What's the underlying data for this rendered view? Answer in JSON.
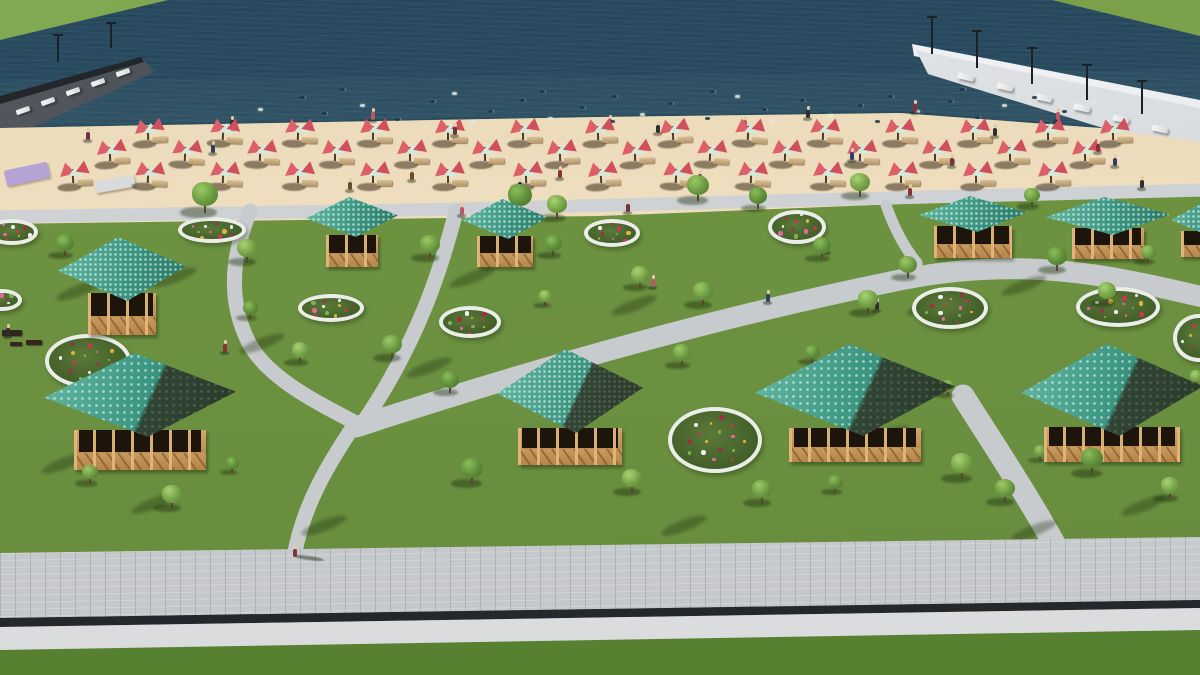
{
  "scene": {
    "type": "architectural-3d-render",
    "subject": "aerial view of lakeside beach park with gazebos, parasols, flower beds and promenade",
    "colors": {
      "water": "#2b5064",
      "sand": "#eddcbc",
      "grass": "#6b9040",
      "grass_lower": "#5e8636",
      "path": "#c8cbcd",
      "promenade": "#cdd0d2",
      "curb": "#eef0f2",
      "gap": "#24272b",
      "roof_teal": "#389480",
      "wood": "#c79a5e",
      "wood_dark": "#1d140b",
      "umbrella_red": "#dd5f68",
      "umbrella_mint": "#d4e9da",
      "flower_rim": "#eaede8",
      "pier_left": "#3a3f46",
      "pier_right": "#dcdfe1",
      "bank_green": "#74a04a",
      "mat_purple": "#b4a3d4",
      "mat_gray": "#d9dadb"
    },
    "paths": {
      "walkway": "M-5,217 L460,209 L1205,190",
      "s_curve": "M250,211 C233,252 226,298 249,343 C268,379 320,404 356,423",
      "branch_b": "M456,211 C443,262 420,340 362,424",
      "main_diagonal": "M356,427 C530,370 720,316 905,279 C1030,255 1120,278 1203,297",
      "spur": "M886,205 C894,228 904,247 917,263",
      "branch_d": "M353,427 C329,463 303,505 294,557",
      "branch_e": "M963,396 C992,442 1032,502 1058,551"
    },
    "gazebos": [
      {
        "cx": 122,
        "roofTop": 237,
        "roofW": 128,
        "roofH": 64,
        "bodyW": 68,
        "bodyH": 42,
        "bodyTop": 293,
        "dark": 0
      },
      {
        "cx": 352,
        "roofTop": 197,
        "roofW": 92,
        "roofH": 40,
        "bodyW": 52,
        "bodyH": 32,
        "bodyTop": 235,
        "dark": 0
      },
      {
        "cx": 505,
        "roofTop": 199,
        "roofW": 86,
        "roofH": 40,
        "bodyW": 56,
        "bodyH": 31,
        "bodyTop": 236,
        "dark": 0
      },
      {
        "cx": 973,
        "roofTop": 196,
        "roofW": 108,
        "roofH": 36,
        "bodyW": 78,
        "bodyH": 32,
        "bodyTop": 226,
        "dark": 0
      },
      {
        "cx": 1108,
        "roofTop": 197,
        "roofW": 125,
        "roofH": 38,
        "bodyW": 72,
        "bodyH": 31,
        "bodyTop": 228,
        "dark": 0
      },
      {
        "cx": 1202,
        "roofTop": 204,
        "roofW": 62,
        "roofH": 30,
        "bodyW": 42,
        "bodyH": 26,
        "bodyTop": 231,
        "dark": 0
      },
      {
        "cx": 140,
        "roofTop": 353,
        "roofW": 192,
        "roofH": 84,
        "bodyW": 132,
        "bodyH": 40,
        "bodyTop": 430,
        "dark": 1
      },
      {
        "cx": 570,
        "roofTop": 349,
        "roofW": 146,
        "roofH": 84,
        "bodyW": 104,
        "bodyH": 37,
        "bodyTop": 428,
        "dark": 1
      },
      {
        "cx": 855,
        "roofTop": 344,
        "roofW": 200,
        "roofH": 92,
        "bodyW": 132,
        "bodyH": 34,
        "bodyTop": 428,
        "dark": 1
      },
      {
        "cx": 1112,
        "roofTop": 344,
        "roofW": 182,
        "roofH": 92,
        "bodyW": 136,
        "bodyH": 35,
        "bodyTop": 427,
        "dark": 1
      }
    ],
    "flowerbeds": [
      [
        12,
        232,
        26,
        13
      ],
      [
        212,
        230,
        34,
        13
      ],
      [
        331,
        308,
        33,
        14
      ],
      [
        470,
        322,
        31,
        16
      ],
      [
        612,
        233,
        28,
        14
      ],
      [
        797,
        227,
        29,
        17
      ],
      [
        950,
        308,
        38,
        21
      ],
      [
        1118,
        307,
        42,
        20
      ],
      [
        1199,
        338,
        26,
        24
      ],
      [
        715,
        440,
        47,
        33
      ],
      [
        88,
        361,
        43,
        27
      ],
      [
        2,
        300,
        20,
        11
      ]
    ],
    "flower_palette": [
      "#cf3550",
      "#e46a9e",
      "#f2f1ee",
      "#e0b43c",
      "#83b152",
      "#a22d3f"
    ],
    "trees": [
      [
        205,
        212,
        26
      ],
      [
        520,
        212,
        24
      ],
      [
        557,
        218,
        20
      ],
      [
        698,
        200,
        22
      ],
      [
        758,
        208,
        18
      ],
      [
        860,
        196,
        20
      ],
      [
        1032,
        206,
        16
      ],
      [
        65,
        255,
        18
      ],
      [
        247,
        262,
        20
      ],
      [
        430,
        258,
        20
      ],
      [
        553,
        255,
        17
      ],
      [
        640,
        287,
        18
      ],
      [
        703,
        305,
        20
      ],
      [
        822,
        258,
        18
      ],
      [
        868,
        313,
        20
      ],
      [
        908,
        277,
        18
      ],
      [
        1057,
        270,
        20
      ],
      [
        1107,
        303,
        18
      ],
      [
        1148,
        262,
        15
      ],
      [
        250,
        318,
        15
      ],
      [
        300,
        362,
        17
      ],
      [
        392,
        358,
        20
      ],
      [
        450,
        392,
        18
      ],
      [
        545,
        305,
        13
      ],
      [
        682,
        365,
        18
      ],
      [
        812,
        362,
        15
      ],
      [
        872,
        405,
        16
      ],
      [
        948,
        395,
        13
      ],
      [
        472,
        483,
        22
      ],
      [
        632,
        492,
        20
      ],
      [
        762,
        503,
        20
      ],
      [
        552,
        455,
        15
      ],
      [
        172,
        508,
        20
      ],
      [
        90,
        483,
        16
      ],
      [
        232,
        472,
        13
      ],
      [
        962,
        478,
        22
      ],
      [
        1005,
        502,
        20
      ],
      [
        1092,
        473,
        22
      ],
      [
        1170,
        498,
        18
      ],
      [
        1040,
        460,
        13
      ],
      [
        835,
        492,
        15
      ],
      [
        1196,
        385,
        13
      ]
    ],
    "umbrella_rows": [
      {
        "y": 132,
        "xs": [
          150,
          225,
          300,
          375,
          450,
          525,
          600,
          675,
          750,
          825,
          900,
          975,
          1050,
          1115
        ]
      },
      {
        "y": 153,
        "xs": [
          112,
          187,
          262,
          337,
          412,
          487,
          562,
          637,
          712,
          787,
          862,
          937,
          1012,
          1087
        ]
      },
      {
        "y": 175,
        "xs": [
          75,
          150,
          225,
          300,
          375,
          450,
          528,
          603,
          678,
          753,
          828,
          903,
          978,
          1053
        ]
      }
    ],
    "people": [
      [
        88,
        140,
        0
      ],
      [
        213,
        153,
        1
      ],
      [
        232,
        128,
        3
      ],
      [
        373,
        120,
        2
      ],
      [
        412,
        180,
        4
      ],
      [
        455,
        135,
        0
      ],
      [
        520,
        190,
        3
      ],
      [
        560,
        178,
        5
      ],
      [
        610,
        127,
        1
      ],
      [
        658,
        133,
        3
      ],
      [
        700,
        182,
        0
      ],
      [
        745,
        128,
        2
      ],
      [
        808,
        118,
        3
      ],
      [
        852,
        160,
        1
      ],
      [
        915,
        112,
        5
      ],
      [
        952,
        166,
        0
      ],
      [
        995,
        136,
        3
      ],
      [
        1058,
        120,
        2
      ],
      [
        1098,
        152,
        5
      ],
      [
        1115,
        166,
        1
      ],
      [
        1142,
        188,
        3
      ],
      [
        350,
        190,
        4
      ],
      [
        462,
        215,
        2
      ],
      [
        628,
        212,
        0
      ],
      [
        910,
        196,
        5
      ],
      [
        225,
        352,
        5
      ],
      [
        8,
        336,
        3
      ],
      [
        768,
        302,
        1
      ],
      [
        877,
        310,
        3
      ],
      [
        827,
        252,
        0
      ],
      [
        653,
        287,
        2
      ],
      [
        295,
        557,
        5
      ]
    ],
    "people_palette": [
      "#6e3340",
      "#343d66",
      "#b65a69",
      "#2e2e31",
      "#6d4a2d",
      "#8a2f3b"
    ],
    "swimmers": [
      [
        258,
        108
      ],
      [
        300,
        96
      ],
      [
        322,
        112
      ],
      [
        360,
        104
      ],
      [
        395,
        118
      ],
      [
        430,
        100
      ],
      [
        452,
        92
      ],
      [
        488,
        110
      ],
      [
        520,
        99
      ],
      [
        548,
        117
      ],
      [
        580,
        106
      ],
      [
        612,
        95
      ],
      [
        640,
        113
      ],
      [
        668,
        102
      ],
      [
        705,
        117
      ],
      [
        735,
        95
      ],
      [
        762,
        108
      ],
      [
        800,
        99
      ],
      [
        828,
        114
      ],
      [
        858,
        104
      ],
      [
        888,
        95
      ],
      [
        915,
        110
      ],
      [
        948,
        100
      ],
      [
        975,
        116
      ],
      [
        1002,
        104
      ],
      [
        1032,
        96
      ],
      [
        1062,
        110
      ],
      [
        1092,
        100
      ],
      [
        340,
        88
      ],
      [
        710,
        90
      ],
      [
        770,
        120
      ],
      [
        875,
        120
      ],
      [
        610,
        120
      ],
      [
        470,
        121
      ],
      [
        540,
        90
      ],
      [
        960,
        88
      ]
    ],
    "shadow_streaks": [
      [
        55,
        285
      ],
      [
        150,
        272
      ],
      [
        238,
        338
      ],
      [
        448,
        272
      ],
      [
        610,
        300
      ],
      [
        905,
        300
      ],
      [
        1000,
        280
      ],
      [
        405,
        362
      ],
      [
        690,
        430
      ],
      [
        40,
        458
      ],
      [
        130,
        498
      ],
      [
        300,
        520
      ],
      [
        660,
        520
      ],
      [
        1010,
        525
      ],
      [
        1120,
        500
      ],
      [
        862,
        430
      ]
    ],
    "pier_left": {
      "loungers": 5,
      "lamps": [
        [
          57,
          34,
          28
        ],
        [
          110,
          22,
          26
        ]
      ]
    },
    "pier_right": {
      "loungers": 6,
      "lamps": [
        [
          931,
          16,
          38
        ],
        [
          976,
          30,
          38
        ],
        [
          1031,
          47,
          37
        ],
        [
          1086,
          64,
          36
        ],
        [
          1141,
          80,
          34
        ]
      ]
    },
    "mats": [
      {
        "x": 5,
        "y": 166,
        "w": 44,
        "h": 16,
        "rot": -12,
        "color": "#b4a3d4"
      },
      {
        "x": 95,
        "y": 178,
        "w": 40,
        "h": 12,
        "rot": -10,
        "color": "#d9dadb"
      }
    ],
    "playground": [
      [
        2,
        330,
        20,
        6
      ],
      [
        26,
        340,
        16,
        5
      ],
      [
        10,
        342,
        12,
        4
      ]
    ]
  }
}
